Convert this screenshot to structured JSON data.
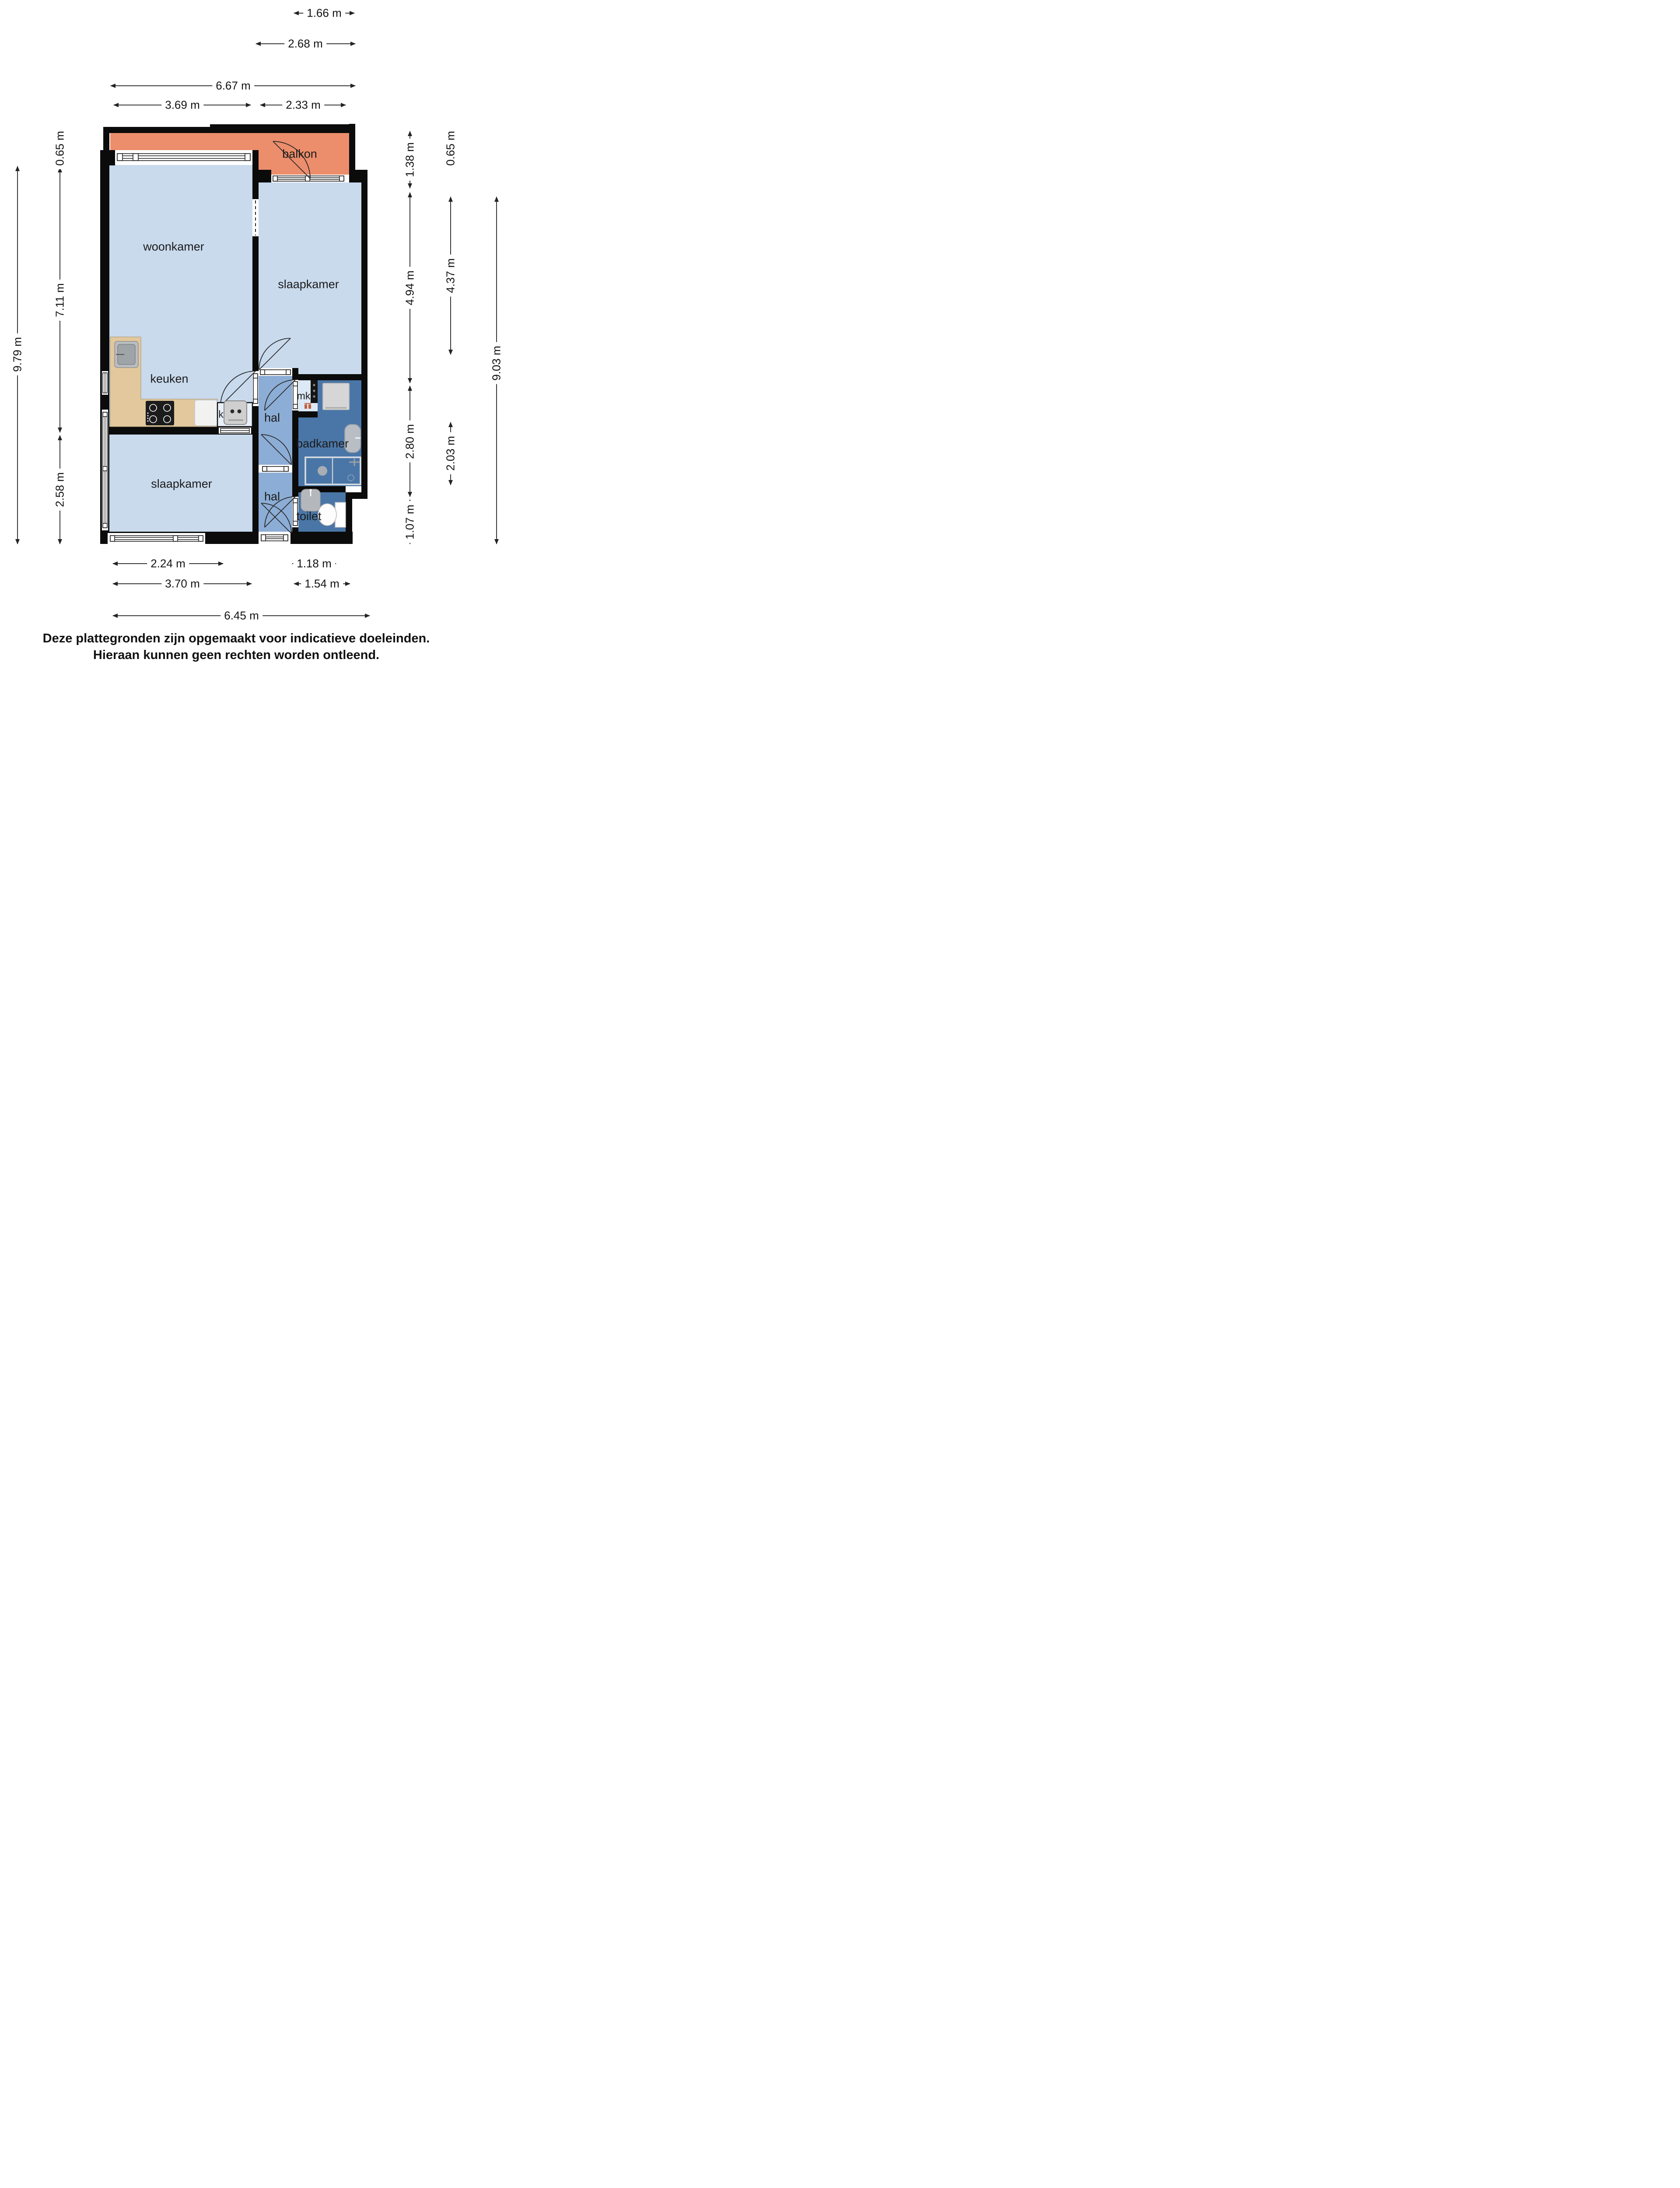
{
  "plan": {
    "room_labels": {
      "balkon": "balkon",
      "woonkamer": "woonkamer",
      "slaapkamer_top": "slaapkamer",
      "slaapkamer_bottom": "slaapkamer",
      "keuken": "keuken",
      "hal_top": "hal",
      "hal_bottom": "hal",
      "badkamer": "badkamer",
      "toilet": "toilet",
      "meterkast": "mk",
      "kast": "k"
    },
    "dimensions_top": [
      "1.66 m",
      "2.68 m",
      "6.67 m",
      "3.69 m",
      "2.33 m"
    ],
    "dimensions_bottom": [
      "2.24 m",
      "1.18 m",
      "3.70 m",
      "1.54 m",
      "6.45 m"
    ],
    "dimensions_left": [
      "0.65 m",
      "7.11 m",
      "2.58 m",
      "9.79 m"
    ],
    "dimensions_right_inner": [
      "1.38 m",
      "4.94 m",
      "2.80 m",
      "1.07 m"
    ],
    "dimensions_right_mid": [
      "0.65 m",
      "4.37 m",
      "2.03 m"
    ],
    "dimensions_right_outer": [
      "9.03 m"
    ],
    "colors": {
      "room_light": "#c9daed",
      "hall_blue": "#8cadd5",
      "bath_blue": "#4a76a7",
      "balcony_orange": "#ec8d6c",
      "wall_black": "#0b0b0b",
      "counter_wood": "#e2c89c"
    }
  },
  "footer": {
    "line1": "Deze plattegronden zijn opgemaakt voor indicatieve doeleinden.",
    "line2": "Hieraan kunnen geen rechten worden ontleend."
  }
}
